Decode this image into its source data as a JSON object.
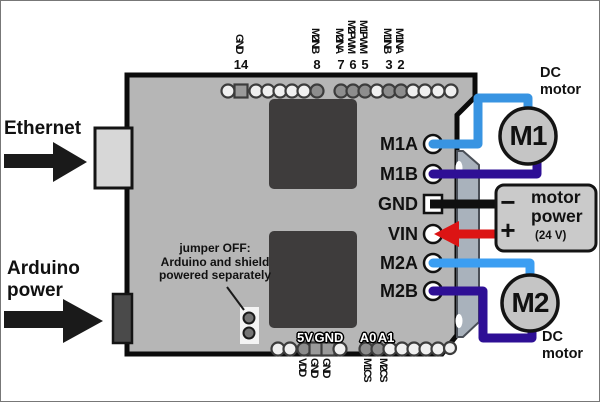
{
  "palette": {
    "board": "#b6b6b6",
    "board_edge": "#0b0b0b",
    "chip": "#3e3c3c",
    "strip": "#a9b2bc",
    "connector_light": "#d7d7d7",
    "connector_dark": "#4a4a4a",
    "pad_light": "#f0f0f0",
    "pad_dark": "#8d8d8d",
    "pad_square": "#9a9a9a",
    "motor_fill": "#c5c5c5",
    "box_fill": "#cacaca",
    "arrow_black": "#1a1a1a",
    "wire_m1a": "#3894e2",
    "wire_m1b": "#2e0f95",
    "wire_gnd": "#101010",
    "wire_vin": "#dc1414",
    "wire_m2a": "#3b9ef2",
    "wire_m2b": "#2e0f95"
  },
  "left_annotations": {
    "ethernet_label": "Ethernet",
    "power_label_line1": "Arduino",
    "power_label_line2": "power"
  },
  "top_header": {
    "pins": [
      {
        "name": "GND",
        "number": "14"
      },
      {
        "name": "M2INB",
        "number": "8"
      },
      {
        "name": "M2INA",
        "number": "7"
      },
      {
        "name": "M2PWM",
        "number": "6"
      },
      {
        "name": "M1PWM",
        "number": "5"
      },
      {
        "name": "M1INB",
        "number": "3"
      },
      {
        "name": "M1INA",
        "number": "2"
      }
    ]
  },
  "right_pins": [
    "M1A",
    "M1B",
    "GND",
    "VIN",
    "M2A",
    "M2B"
  ],
  "bottom_header": {
    "board_labels": [
      "5V",
      "GND",
      "A0",
      "A1"
    ],
    "below_labels": [
      "VDD",
      "GND",
      "GND",
      "M1CS",
      "M2CS"
    ]
  },
  "jumper_note": {
    "line1": "jumper OFF:",
    "line2": "Arduino and shield",
    "line3": "powered separately"
  },
  "motor_power_box": {
    "minus": "−",
    "plus": "+",
    "title_line1": "motor",
    "title_line2": "power",
    "voltage": "(24 V)"
  },
  "motors": [
    {
      "label": "M1",
      "caption_line1": "DC",
      "caption_line2": "motor"
    },
    {
      "label": "M2",
      "caption_line1": "DC",
      "caption_line2": "motor"
    }
  ]
}
